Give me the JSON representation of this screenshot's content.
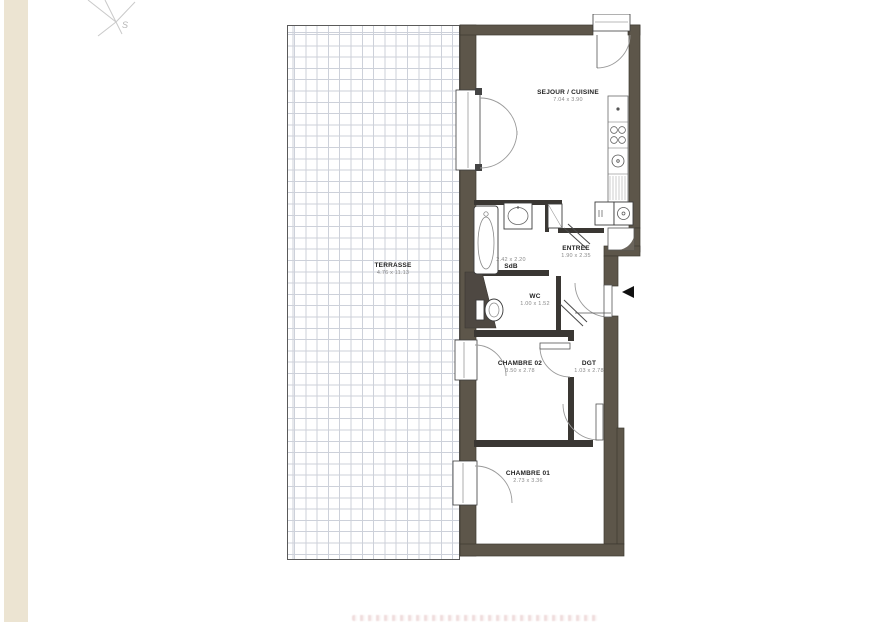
{
  "page": {
    "background": "#ffffff",
    "sidebar_color": "#ece4d2"
  },
  "compass": {
    "south_label": "S"
  },
  "plan": {
    "colors": {
      "wall": "#5d564a",
      "partition": "#3a3733",
      "grid_line": "#cdd1da",
      "door_arc": "#9a9a9a",
      "fixture_line": "#444444",
      "entry_arrow": "#111111"
    },
    "rooms": [
      {
        "id": "terrasse",
        "name": "TERRASSE",
        "dims": "4.76 x 11.13"
      },
      {
        "id": "sejour-cuisine",
        "name": "SEJOUR / CUISINE",
        "dims": "7.04 x 3.90"
      },
      {
        "id": "sdb",
        "name": "SdB",
        "dims": "2.42 x 2.20"
      },
      {
        "id": "entree",
        "name": "ENTREE",
        "dims": "1.90 x 2.35"
      },
      {
        "id": "wc",
        "name": "WC",
        "dims": "1.00 x 1.52"
      },
      {
        "id": "chambre-02",
        "name": "CHAMBRE 02",
        "dims": "3.50 x 2.78"
      },
      {
        "id": "dgt",
        "name": "DGT",
        "dims": "1.03 x 2.78"
      },
      {
        "id": "chambre-01",
        "name": "CHAMBRE 01",
        "dims": "2.73 x 3.36"
      }
    ]
  }
}
